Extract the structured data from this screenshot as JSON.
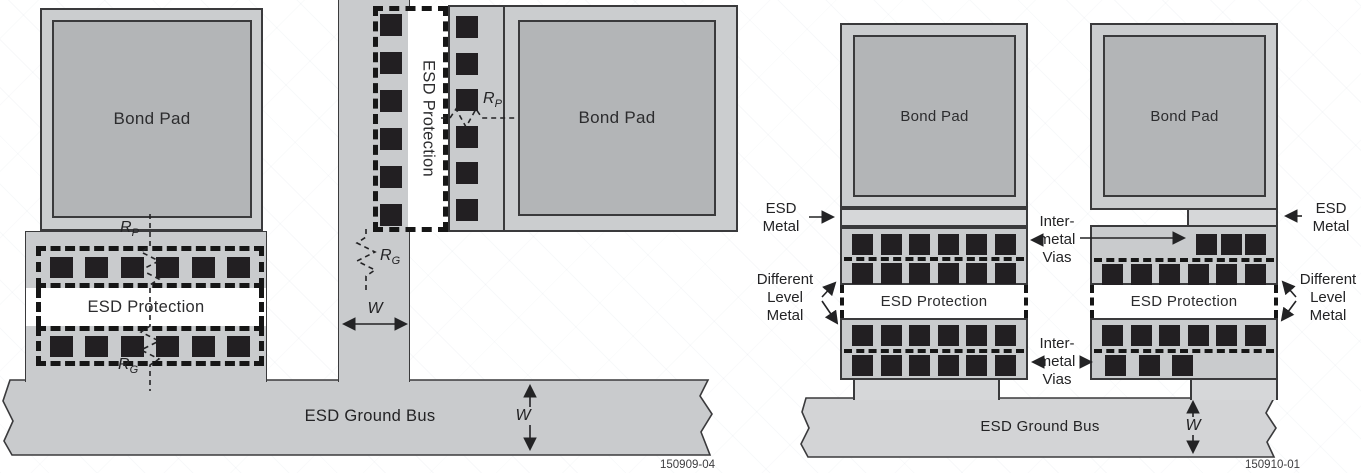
{
  "figure_left": {
    "footer_id": "150909-04",
    "bond_pad_left": "Bond Pad",
    "bond_pad_right": "Bond Pad",
    "esd_protection_row_label": "ESD Protection",
    "esd_protection_column_label": "ESD Protection",
    "ground_bus_label": "ESD Ground Bus",
    "resistors": {
      "pad_row": {
        "base": "R",
        "sub": "P"
      },
      "ground_row": {
        "base": "R",
        "sub": "G"
      },
      "pad_column": {
        "base": "R",
        "sub": "P"
      },
      "ground_column": {
        "base": "R",
        "sub": "G"
      }
    },
    "width_labels": {
      "column": "W",
      "bus": "W"
    }
  },
  "figure_right": {
    "footer_id": "150910-01",
    "bond_pad_left": "Bond Pad",
    "bond_pad_right": "Bond Pad",
    "esd_protection_left_label": "ESD Protection",
    "esd_protection_right_label": "ESD Protection",
    "ground_bus_label": "ESD Ground Bus",
    "esd_metal_left": {
      "line1": "ESD",
      "line2": "Metal"
    },
    "esd_metal_right": {
      "line1": "ESD",
      "line2": "Metal"
    },
    "inter_metal_vias_top": {
      "line1": "Inter-",
      "line2": "metal",
      "line3": "Vias"
    },
    "inter_metal_vias_bottom": {
      "line1": "Inter-",
      "line2": "metal",
      "line3": "Vias"
    },
    "different_level_metal_left": {
      "line1": "Different",
      "line2": "Level",
      "line3": "Metal"
    },
    "different_level_metal_right": {
      "line1": "Different",
      "line2": "Level",
      "line3": "Metal"
    },
    "width_labels": {
      "bus": "W"
    }
  },
  "colors": {
    "metal": "#c9cbcd",
    "metal_light": "#d6d7d9",
    "pad_outer": "#cbcdcf",
    "pad_inner": "#b3b5b7",
    "via": "#221f22",
    "line": "#3a3a3c",
    "bus_left": "#c9cbcd",
    "bus_right": "#d3d4d6",
    "band": "#ffffff",
    "ink": "#262628"
  }
}
